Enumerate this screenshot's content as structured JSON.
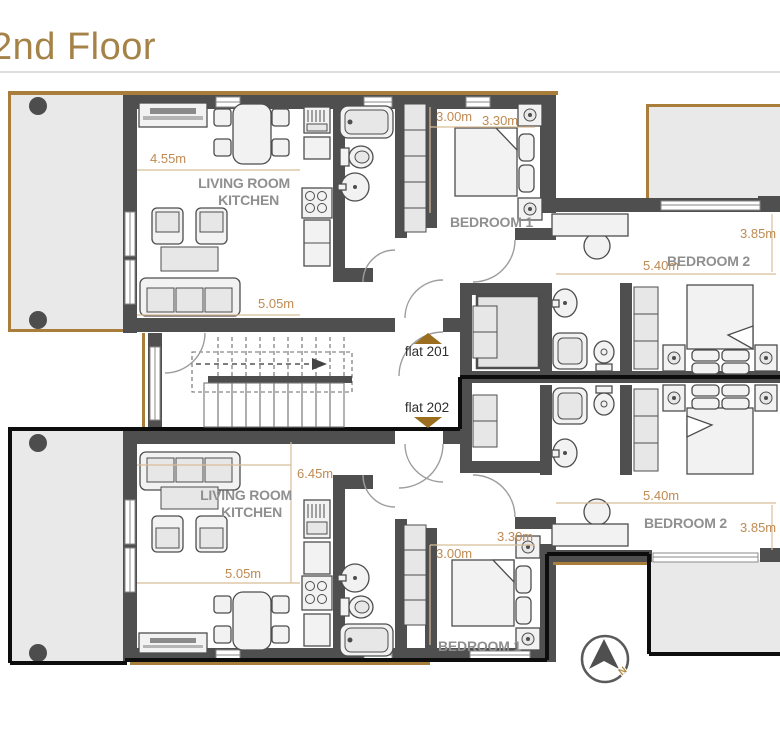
{
  "title": "2nd Floor",
  "compass": {
    "north_label": "N"
  },
  "flat201": {
    "label": "flat 201",
    "living_kitchen": {
      "name_line1": "LIVING ROOM",
      "name_line2": "KITCHEN",
      "width": "4.55m",
      "length": "5.05m"
    },
    "bedroom1": {
      "name": "BEDROOM 1",
      "width": "3.00m",
      "length": "3.30m"
    },
    "bedroom2": {
      "name": "BEDROOM 2",
      "length": "5.40m",
      "width": "3.85m"
    }
  },
  "flat202": {
    "label": "flat 202",
    "living_kitchen": {
      "name_line1": "LIVING ROOM",
      "name_line2": "KITCHEN",
      "depth": "6.45m",
      "width": "5.05m"
    },
    "bedroom1": {
      "name": "BEDROOM 1",
      "width": "3.00m",
      "length": "3.30m"
    },
    "bedroom2": {
      "name": "BEDROOM 2",
      "length": "5.40m",
      "width": "3.85m"
    }
  },
  "colors": {
    "title_text": "#a58348",
    "dimension_text": "#bf8a52",
    "dimension_line": "#d8bd98",
    "room_label_gray": "#8f8f8f",
    "wall_gray": "#4f4f4f",
    "flat202_outline_black": "#0d0d0d",
    "balcony_border_brown": "#a87e3a",
    "flat_arrow_brown": "#9b6d1e",
    "balcony_fill": "#e9e9e9",
    "north_label_gold": "#b08b3e"
  }
}
